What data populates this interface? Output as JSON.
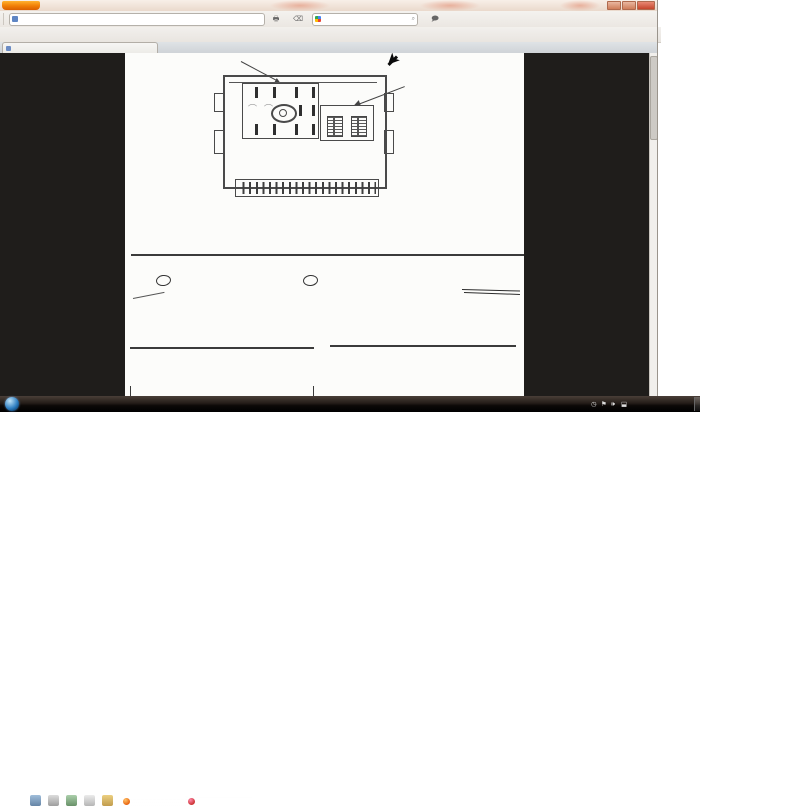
{
  "window": {
    "app_button": "Firefox",
    "controls": {
      "minimize": "—",
      "maximize": "❐",
      "close": "✕"
    },
    "tab": {
      "title": "file.php (JPEG obrázek, 502 × 1621 bodů)",
      "new_tab": "+"
    },
    "nav": {
      "buttons": [
        {
          "label": "Zpět",
          "icon": "back-icon",
          "glyph": "←"
        },
        {
          "label": "Vpřed",
          "icon": "forward-icon",
          "glyph": "→"
        },
        {
          "label": "Zrušit",
          "icon": "stop-icon",
          "glyph": "✕"
        },
        {
          "label": "Obnovit",
          "icon": "reload-icon",
          "glyph": "↻"
        },
        {
          "label": "Záložky",
          "icon": "bookmarks-icon",
          "glyph": "▮"
        },
        {
          "label": "Historie",
          "icon": "history-icon",
          "glyph": "◷"
        },
        {
          "label": "Domů",
          "icon": "home-icon",
          "glyph": "⌂"
        },
        {
          "label": "eBay",
          "icon": "ebay-icon",
          "glyph": "e▾"
        }
      ],
      "url": "www.ford-focus.cz/forum/download/file.php?id=39448&mode=view",
      "star": "☆",
      "url_drop": "▾",
      "print_label": "Tisk",
      "clear_label": "Vymazat",
      "search_placeholder": "Google",
      "search_mag": "🔍",
      "translator_label": "ImTranslator"
    },
    "bookmarks": [
      "WetterOnline",
      "radar počasí",
      "Bike Forum",
      "E-bay Cyklo",
      "eBay autoteile",
      "eBay Angebote",
      "Ebay .CZ",
      "YouTube",
      "AhaDrby hry",
      "Ulož.to!",
      "WWW Scanner",
      "Live Flight Tracker!",
      "Ford Focus Forum - O...",
      "Doprava i nehody",
      "Google.cz",
      "cihla střelec Egypt"
    ],
    "bookmarks_overflow": "»"
  },
  "scan": {
    "part_a": "PART A",
    "part_f": "PART F",
    "part_b": "PART  B",
    "part_c": "PART  C",
    "scale": "SCALE  2:1",
    "pa_top": [
      "1",
      "5",
      "9",
      "13"
    ],
    "pa_bottom": [
      "4",
      "8",
      "12",
      "16"
    ],
    "pf_pins": [
      "1",
      "2"
    ],
    "dots_b1": "1 · · · · ·  6",
    "dots_b2": "7 · · · · · 12",
    "dots_c1": "1 · · · · ·  6",
    "dots_c2": "7 · · · · · 12",
    "pin_title": "Pin Designations are:",
    "conn_a_title": "Connector A      Speakers and Power",
    "table_a": [
      [
        "Pin 1",
        "Right\nRear +",
        "Pin 5",
        "Right\nRear –",
        "Pin 9",
        "CAN +",
        "Pin 13",
        "Alarm\nSense"
      ],
      [
        "Pin 2",
        "Right\nFront +",
        "Pin 6",
        "Right\nFront –",
        "Pin 10",
        "CAN –",
        "Pin 14",
        "Illumination"
      ],
      [
        "Pin 3",
        "Left\nFront +",
        "Pin 7",
        "Left\nFront –",
        "Pin 11",
        "Keycode\nGnd",
        "Pin 15",
        "Batt +"
      ],
      [
        "Pin 4",
        "Left\nRear +",
        "Pin 8",
        "Left\nRear –",
        "Pin 12",
        "Gnd",
        "Pin 16",
        "Ign Sense\n(Accessory)"
      ]
    ],
    "pen_star": "✱",
    "conn_b_title": "• Connector B    Aux 1",
    "table_b": [
      [
        "Pin 1",
        "Mono +",
        "Pin 7",
        "Mono –"
      ],
      [
        "Pin 2",
        "Sw A +",
        "Pin 8",
        "SWC Gnd"
      ],
      [
        "Pin 3",
        "Aux L +",
        "Pin 9",
        "Aux L –"
      ],
      [
        "Pin 4",
        "Aux R +",
        "Pin 10",
        "Aux R –"
      ]
    ],
    "conn_c_title": "• Connector C   Aux 1",
    "table_c": [
      [
        "Pin 1",
        "RSE L +",
        "Pin 7",
        "RSE L –"
      ],
      [
        "Pin 2",
        "RSE R +",
        "Pin 8",
        "RSE R –"
      ],
      [
        "Pin 3",
        "Mono 2 +",
        "Pin 9",
        "Mono 2 –"
      ],
      [
        "Pin 4",
        "Sub W +",
        "Pin 10",
        "Sub W –"
      ]
    ]
  },
  "taskbar": {
    "task_buttons": [
      "file.php (JPEG obráz...",
      "ORIGINAL ZUNDKER..."
    ],
    "links_label": "Odkazy",
    "links_chevron": "»",
    "lang": "CS",
    "tray_chevron": "▴",
    "time": "19:33"
  },
  "colors": {
    "accent_orange": "#f07d05",
    "content_bg": "#1f1d1b",
    "page_bg": "#fcfcfa",
    "taskbar_bg": "#14100d"
  }
}
